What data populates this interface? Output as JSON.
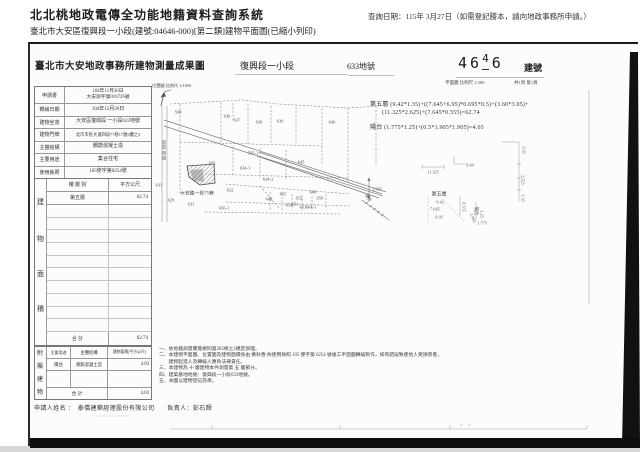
{
  "header": {
    "system_title": "北北桃地政電傳全功能地籍資料查詢系統",
    "query_date": "查詢日期：115年 3月27日（如需登記謄本，請向地政事務所申請。）",
    "subtitle": "臺北市大安區復興段一小段(建號:04646-000)[第二類]建物平面圖(已縮小列印)"
  },
  "document": {
    "office_title": "臺北市大安地政事務所建物測量成果圖",
    "section_name": "復興段一小段",
    "land_no": "633地號",
    "stamp_digits": [
      "4",
      "6",
      "4",
      "6"
    ],
    "building_no_label": "建號",
    "plan_scale": "平面圖 比例尺 1/200",
    "page_info": "共1頁 第1頁",
    "info_rows": [
      {
        "label": "申請書",
        "value": "104年11月26日",
        "value2": "大安測字第016726號"
      },
      {
        "label": "轉繪日期",
        "value": "104年12月26日"
      },
      {
        "label": "建物坐落",
        "value": "大安區復興段 一小段633地號"
      },
      {
        "label": "建物門牌",
        "value": "北市市民大道四段77巷17號5樓之2"
      },
      {
        "label": "主體結構",
        "value": "鋼筋混凝土造"
      },
      {
        "label": "主要用途",
        "value": "集合住宅"
      },
      {
        "label": "使用執照",
        "value": "105使字第0254號"
      }
    ],
    "area_table": {
      "side_label": [
        "建",
        "物",
        "面",
        "積"
      ],
      "header_floor": "樓 層 別",
      "header_sqm": "平方公尺",
      "row_floor": "第五層",
      "row_sqm": "62.74",
      "total_label": "合  計",
      "total_value": "62.74"
    },
    "attached_table": {
      "side_label": [
        "附",
        "屬",
        "建",
        "物"
      ],
      "header_use": "主要用途",
      "header_structure": "主體結構",
      "header_area": "建物面積(平方公尺)",
      "row_use": "陽台",
      "row_structure": "鋼筋混凝土造",
      "row_area": "4.03",
      "total_label": "合  計",
      "total_value": "4.03"
    },
    "notes": [
      "一、依地籍測量實施規則第282條之2規定辦理。",
      "二、本建物平面圖、位置圖及建物面積係由 黃秋香 依使用執照 105 使字第 0254 號竣工平面圖轉繪製作，如有錯誤致使他人受損害者，",
      "　　建物起造人及轉繪人應負法律責任。",
      "三、本建物為 十 層建物本件測量第 五 層部分。",
      "四、建築基地地號：復興段一小段633地號。",
      "五、本圖以建物登記為準。"
    ],
    "applicant": "申請人姓名 ：　泰僑建築經理股份有限公司　　負責人：彭石輝",
    "formula": {
      "line1": "第五層 (9.42*1.35)+((7.645+6.95)*0.695*0.5)+(3.60*3.05)+",
      "line2": "(11.325*2.625)+(7.645*0.555)=62.74",
      "line3": "陽台 (1.775*1.25)+(0.5*1.905*1.905)=4.03"
    },
    "map": {
      "scale_label": "位置圖 比例尺 1/1000",
      "street_label": "大安路一段75巷",
      "street_label_vertical": "復興南路",
      "lots": [
        "598",
        "636",
        "637",
        "638",
        "639",
        "640",
        "595-1",
        "645",
        "635",
        "634-1",
        "634-2",
        "633",
        "632",
        "629",
        "631",
        "646",
        "650",
        "655",
        "648",
        "652",
        "651",
        "653",
        "654",
        "664-1",
        "656-1"
      ]
    },
    "sketch": {
      "floor_label": "第五層",
      "balcony_label": "陽台",
      "dims": [
        "11.325",
        "3.60",
        "3.05",
        "2.625",
        "1.35",
        "9.42",
        "7.645",
        "6.95",
        "0.555",
        "1.905",
        "1.25",
        "1.775"
      ],
      "triangle_dim": "1.905",
      "triangle_label": "陽台"
    }
  }
}
